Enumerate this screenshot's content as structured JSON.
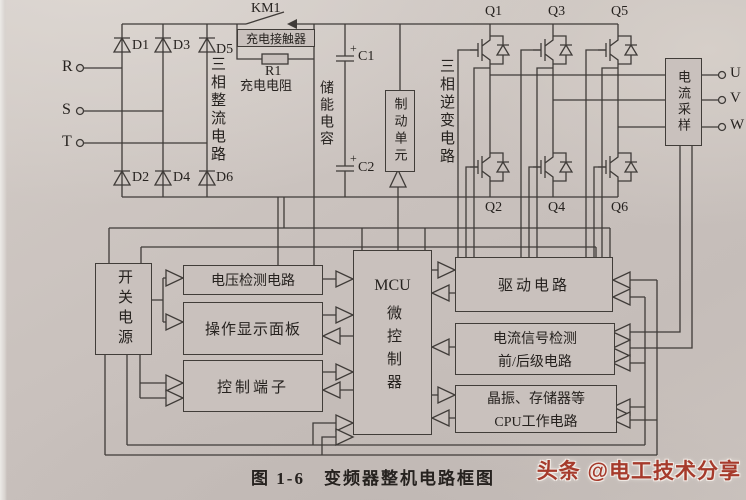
{
  "caption": {
    "text": "图 1-6　变频器整机电路框图"
  },
  "watermark": {
    "text": "头条 @电工技术分享",
    "color": "#a63a2b"
  },
  "inputs": {
    "phases": [
      "R",
      "S",
      "T"
    ]
  },
  "outputs": {
    "phases": [
      "U",
      "V",
      "W"
    ]
  },
  "rectifier": {
    "name": "三相整流电路",
    "top_diodes": [
      "D1",
      "D3",
      "D5"
    ],
    "bottom_diodes": [
      "D2",
      "D4",
      "D6"
    ]
  },
  "precharge": {
    "contactor_ref": "KM1",
    "contactor_name": "充电接触器",
    "resistor_ref": "R1",
    "resistor_name": "充电电阻"
  },
  "dc_link": {
    "name": "储能电容",
    "cap_refs": [
      "C1",
      "C2"
    ],
    "polarity_mark": "+"
  },
  "brake_unit": {
    "name": "制动单元"
  },
  "inverter": {
    "name": "三相逆变电路",
    "top_igbts": [
      "Q1",
      "Q3",
      "Q5"
    ],
    "bottom_igbts": [
      "Q2",
      "Q4",
      "Q6"
    ]
  },
  "current_sampling": {
    "name": "电流采样"
  },
  "control_blocks": {
    "switch_power": "开关电源",
    "voltage_detect": "电压检测电路",
    "operation_panel": "操作显示面板",
    "control_terminals": "控制端子",
    "mcu_title": "MCU",
    "mcu_name": "微控制器",
    "drive_circuit": "驱动电路",
    "current_signal_detect": [
      "电流信号检测",
      "前/后级电路"
    ],
    "cpu_support": [
      "晶振、存储器等",
      "CPU工作电路"
    ]
  },
  "colors": {
    "line": "#3f3b38",
    "paper": "#c9c1bd",
    "watermark_red": "#a63a2b"
  }
}
